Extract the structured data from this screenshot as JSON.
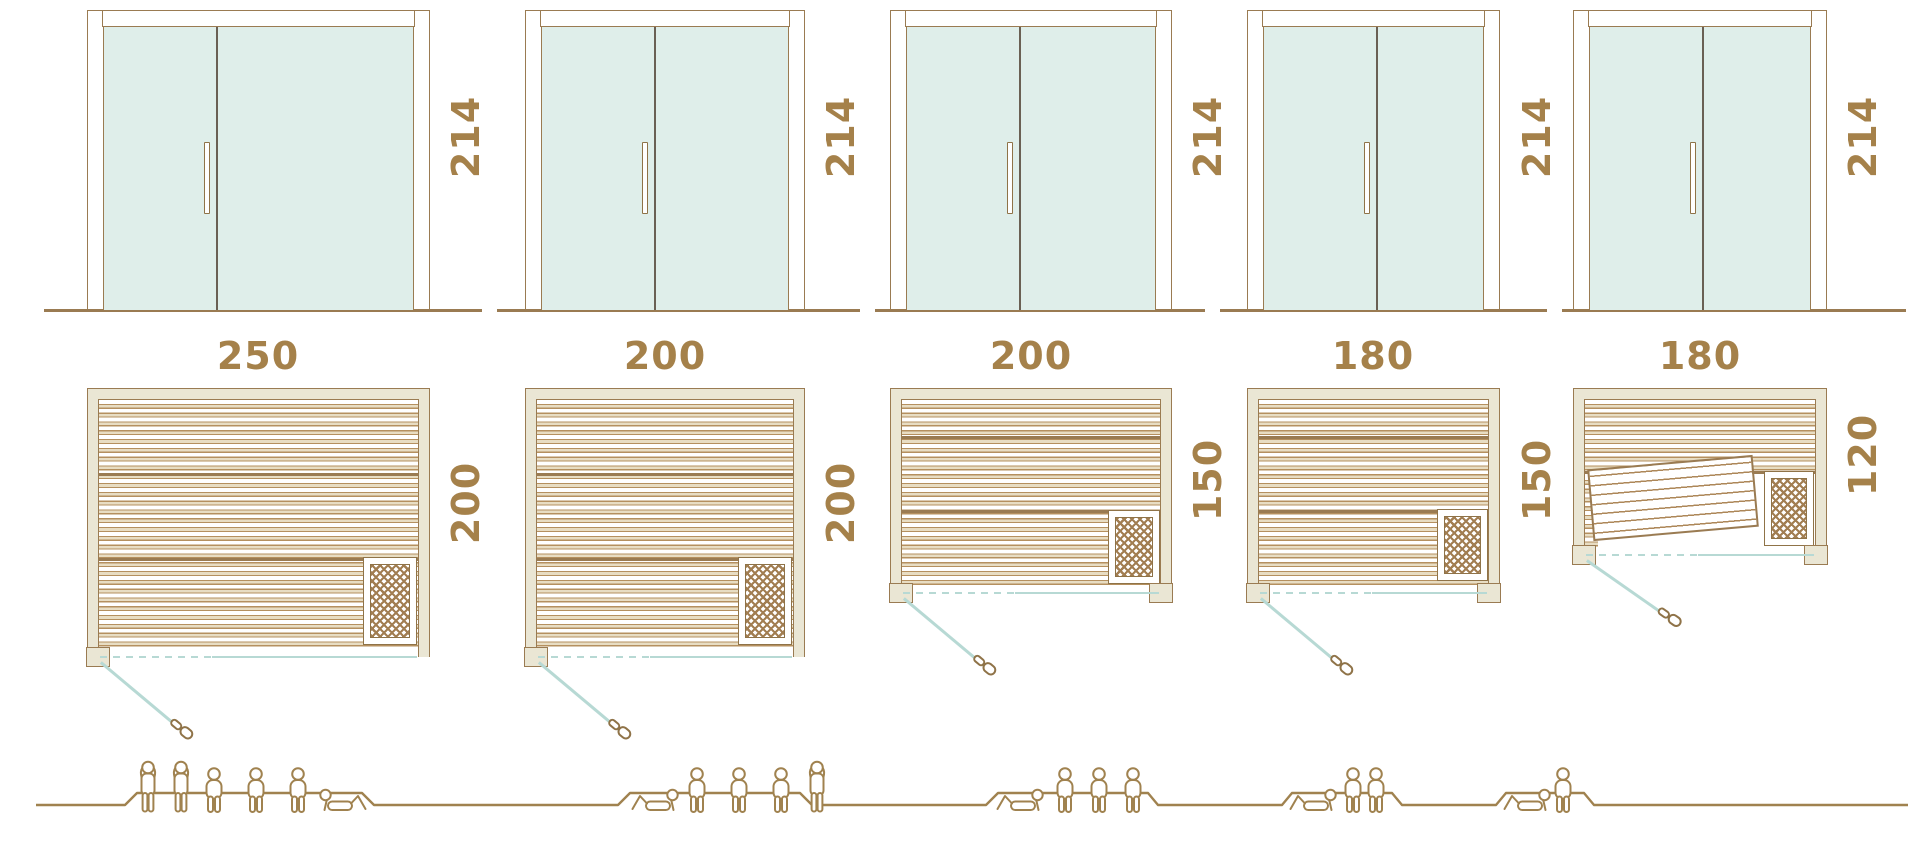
{
  "units": [
    {
      "id": "sauna-1",
      "door_height_cm": "214",
      "width_cm": "250",
      "depth_cm": "200",
      "capacity": {
        "total": 6,
        "standing": 2,
        "seated": 3,
        "lying": 1
      }
    },
    {
      "id": "sauna-2",
      "door_height_cm": "214",
      "width_cm": "200",
      "depth_cm": "200",
      "capacity": {
        "total": 5,
        "standing": 1,
        "seated": 3,
        "lying": 1
      }
    },
    {
      "id": "sauna-3",
      "door_height_cm": "214",
      "width_cm": "200",
      "depth_cm": "150",
      "capacity": {
        "total": 4,
        "standing": 0,
        "seated": 3,
        "lying": 1
      }
    },
    {
      "id": "sauna-4",
      "door_height_cm": "214",
      "width_cm": "180",
      "depth_cm": "150",
      "capacity": {
        "total": 3,
        "standing": 0,
        "seated": 2,
        "lying": 1
      }
    },
    {
      "id": "sauna-5",
      "door_height_cm": "214",
      "width_cm": "180",
      "depth_cm": "120",
      "capacity": {
        "total": 2,
        "standing": 0,
        "seated": 1,
        "lying": 1
      }
    }
  ],
  "colors": {
    "outline_brown": "#9a7b52",
    "dimension_text": "#a5814a",
    "wall_fill": "#eae6d4",
    "glass_teal": "#dfeeea",
    "door_swing_teal": "#b7d9d4",
    "slat_tan": "#e8ddc3",
    "figure_brown": "#a0824f",
    "door_divider_dark": "#6a6054"
  }
}
